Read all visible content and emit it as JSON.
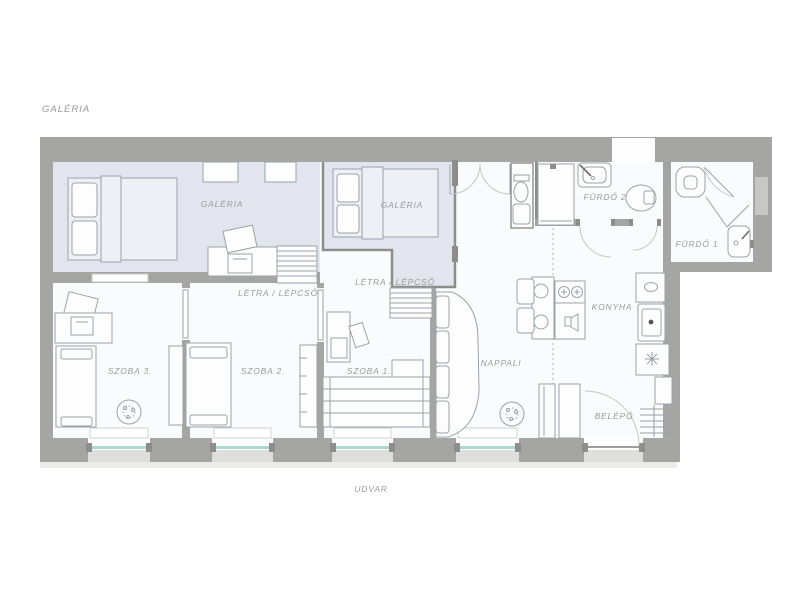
{
  "labels": {
    "outside": {
      "galeria_top": "GALÉRIA",
      "udvar": "UDVAR"
    },
    "rooms": {
      "galeria_left": "GALÉRIA",
      "galeria_mid": "GALÉRIA",
      "letra_left": "LÉTRA / LÉPCSŐ",
      "letra_mid": "LÉTRA / LÉPCSŐ",
      "furdo2": "FÜRDŐ 2",
      "furdo1": "FÜRDŐ 1",
      "szoba3": "SZOBA 3.",
      "szoba2": "SZOBA 2.",
      "szoba1": "SZOBA 1.",
      "nappali": "NAPPALI",
      "konyha": "KONYHA",
      "belepo": "BELÉPŐ"
    }
  },
  "colors": {
    "wall": "#a5a5a3",
    "wall_dark": "#8d8d8b",
    "gallery_fill": "#e2e5ee",
    "room_fill": "#fafbfd",
    "furniture_line": "#9aa2a8",
    "label_text": "#9b9b9b",
    "window_glass": "#aed7d1",
    "window_outer": "#dededd"
  }
}
